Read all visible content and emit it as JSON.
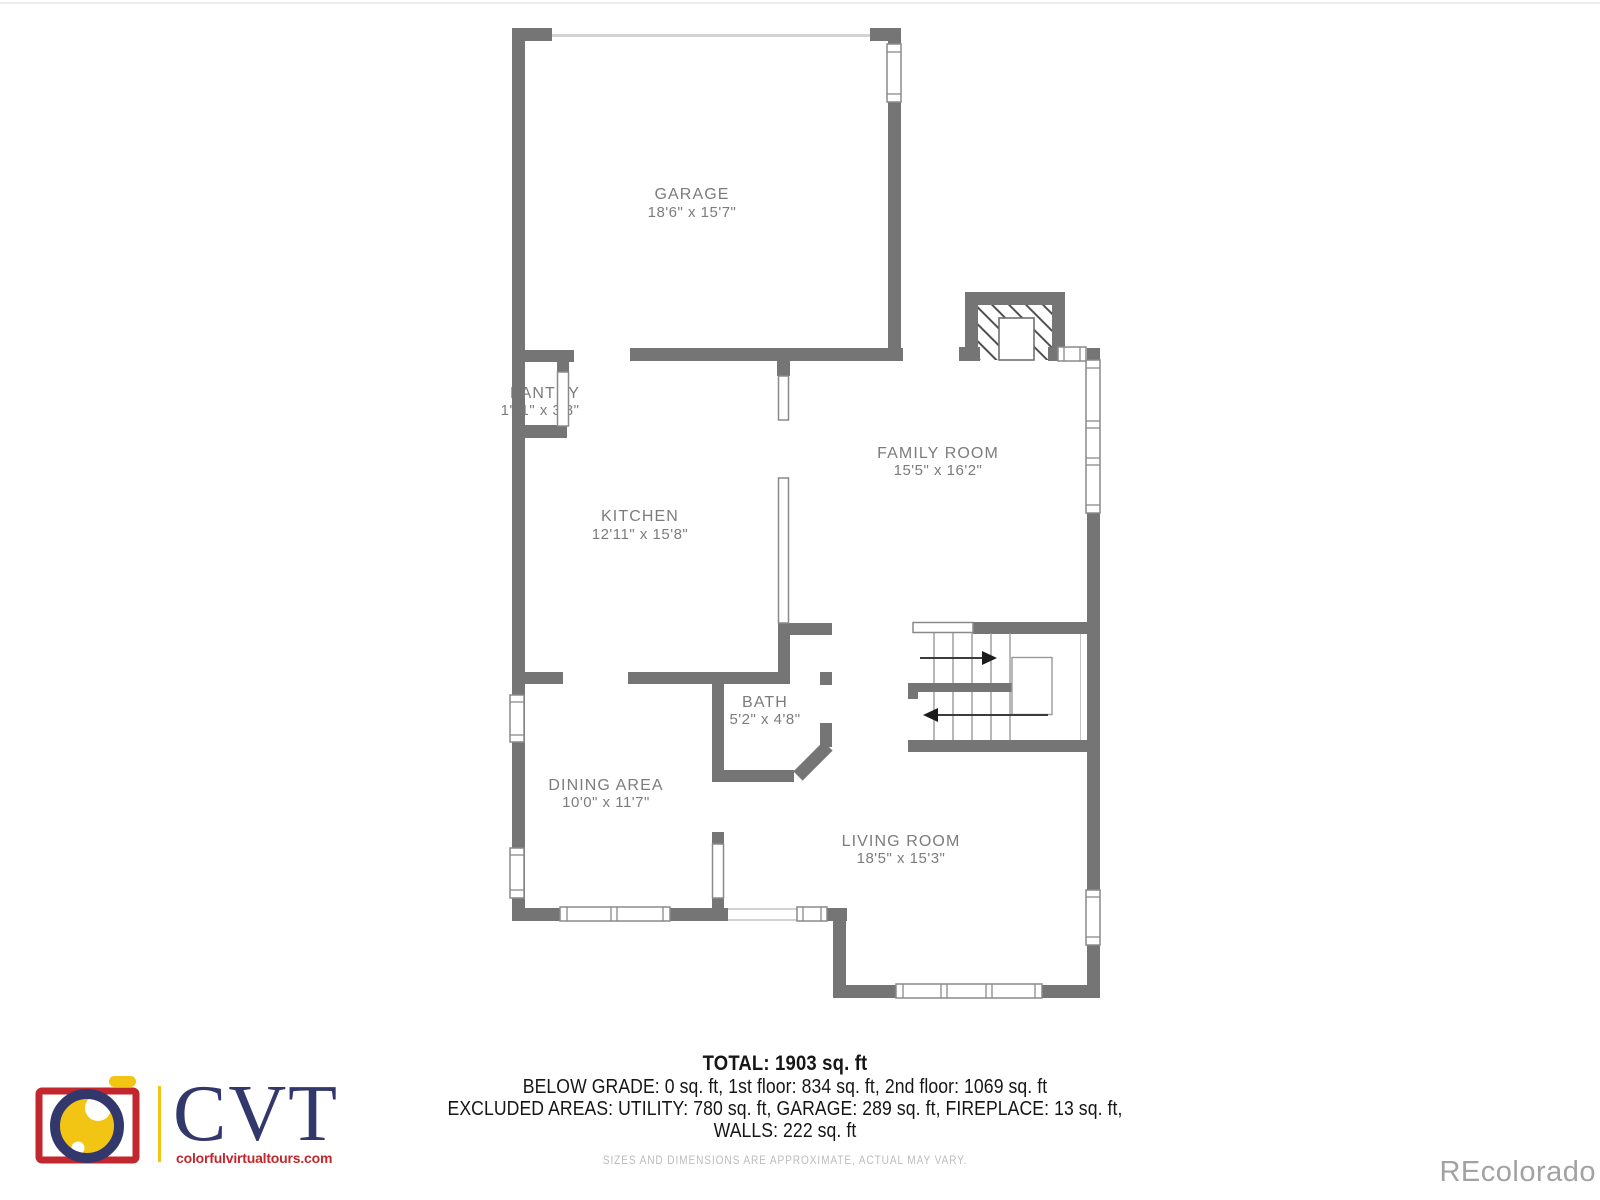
{
  "theme": {
    "bg": "#ffffff",
    "wall": "#757575",
    "winline": "#8a8a8a",
    "label": "#7c7c7c",
    "text": "#161616",
    "muted": "#bcbcbc",
    "watermark": "#a2a2a2",
    "logo_red": "#c1272d",
    "logo_navy": "#32386b",
    "logo_yellow": "#f2c414"
  },
  "icons": {
    "logo": "camera-icon",
    "stairs_up": "arrow-right-icon",
    "stairs_down": "arrow-left-icon"
  },
  "rooms": {
    "garage": {
      "name": "GARAGE",
      "dims": "18'6\" x 15'7\""
    },
    "pantry": {
      "name": "PANTRY",
      "dims": "1'11\" x 3'8\""
    },
    "kitchen": {
      "name": "KITCHEN",
      "dims": "12'11\" x 15'8\""
    },
    "family": {
      "name": "FAMILY ROOM",
      "dims": "15'5\" x 16'2\""
    },
    "bath": {
      "name": "BATH",
      "dims": "5'2\" x 4'8\""
    },
    "dining": {
      "name": "DINING AREA",
      "dims": "10'0\" x 11'7\""
    },
    "living": {
      "name": "LIVING ROOM",
      "dims": "18'5\" x 15'3\""
    }
  },
  "summary": {
    "total": "TOTAL: 1903 sq. ft",
    "line1": "BELOW GRADE: 0 sq. ft, 1st floor: 834 sq. ft, 2nd floor: 1069 sq. ft",
    "line2": "EXCLUDED AREAS: UTILITY: 780 sq. ft, GARAGE: 289 sq. ft, FIREPLACE: 13 sq. ft,",
    "line3": "WALLS: 222 sq. ft",
    "disclaimer": "SIZES AND DIMENSIONS ARE APPROXIMATE, ACTUAL MAY VARY."
  },
  "branding": {
    "logo_text": "CVT",
    "logo_url": "colorfulvirtualtours.com",
    "watermark": "REcolorado"
  }
}
